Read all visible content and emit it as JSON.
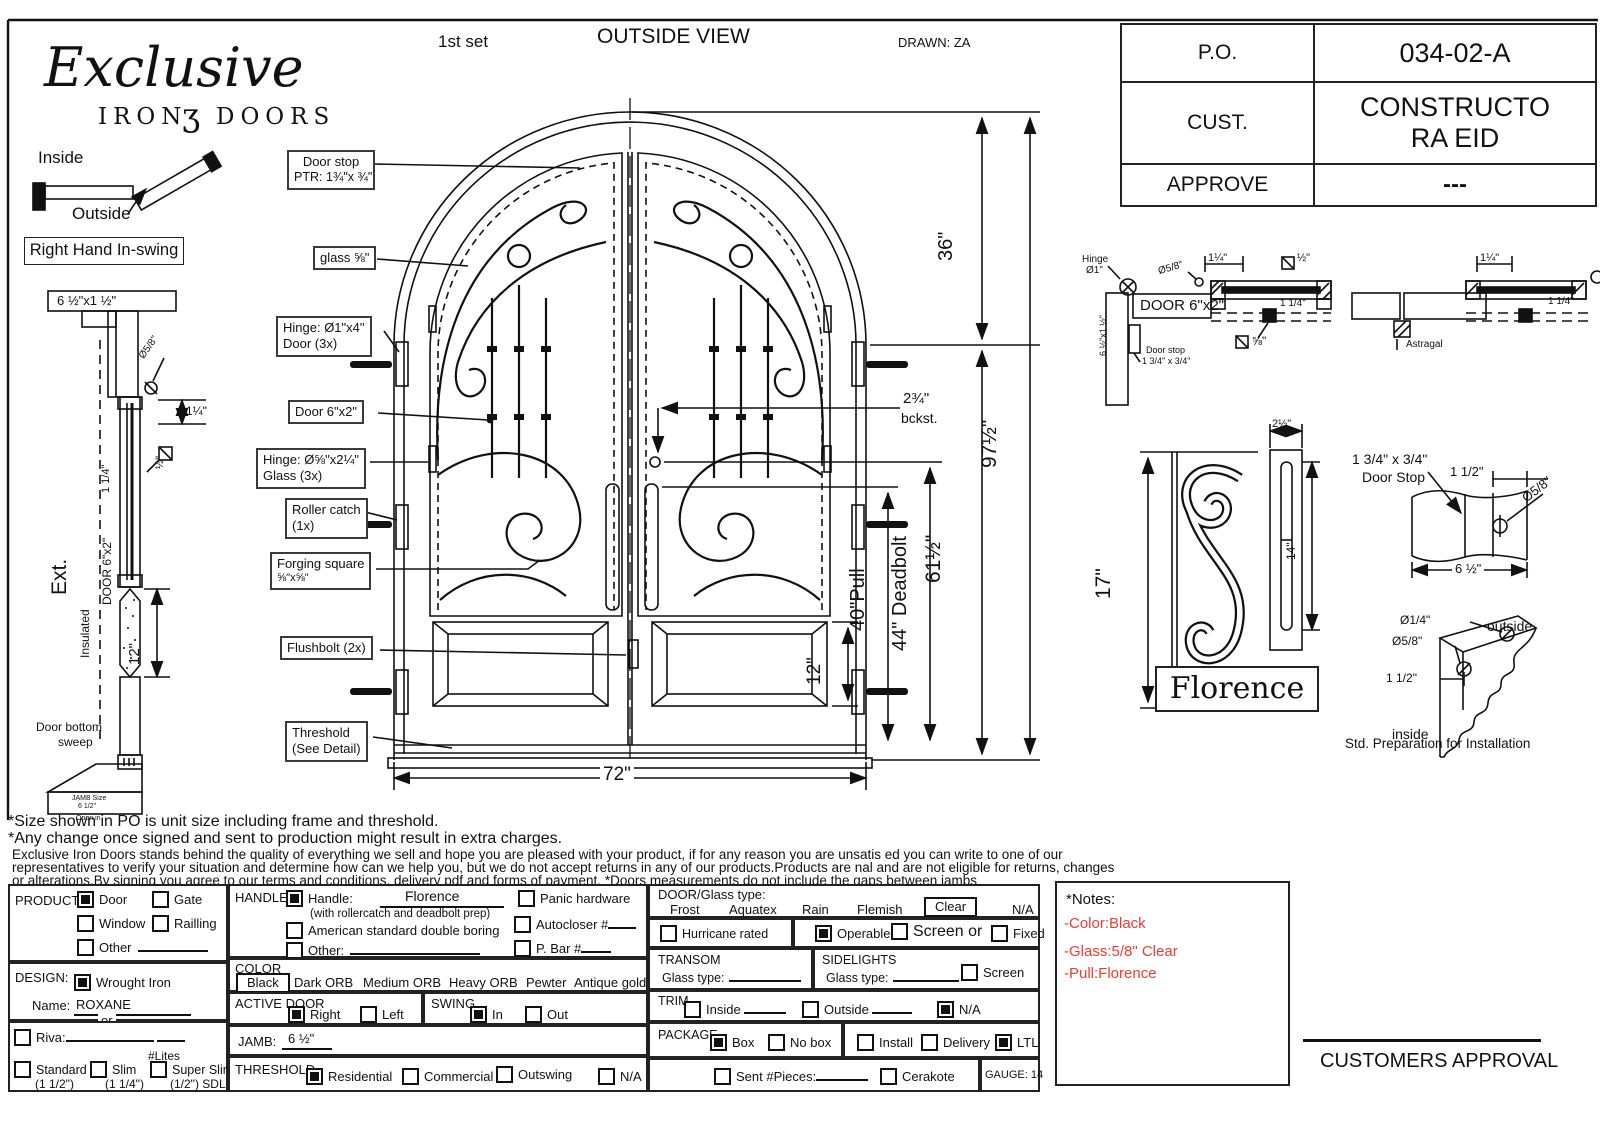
{
  "colors": {
    "ink": "#111111",
    "red": "#f03b30",
    "paper": "#ffffff"
  },
  "header": {
    "set": "1st set",
    "view": "OUTSIDE VIEW",
    "drawn": "DRAWN: ZA"
  },
  "brand": {
    "name": "Exclusive",
    "sub_left": "IRON",
    "scroll": "ʒ",
    "sub_right": "DOORS"
  },
  "orientation": {
    "inside": "Inside",
    "outside": "Outside",
    "swing": "Right Hand In-swing"
  },
  "title_block": {
    "rows": [
      {
        "label": "P.O.",
        "value": "034-02-A"
      },
      {
        "label": "CUST.",
        "value": "CONSTRUCTORA EID"
      },
      {
        "label": "APPROVE",
        "value": "---"
      }
    ]
  },
  "callouts": {
    "door_stop_1": "Door stop",
    "door_stop_2": "PTR: 1¾\"x ¾\"",
    "glass": "glass ⅝\"",
    "hinge_door_1": "Hinge: Ø1\"x4\"",
    "hinge_door_2": "Door (3x)",
    "door": "Door  6\"x2\"",
    "hinge_glass_1": "Hinge: Ø⅝\"x2¼\"",
    "hinge_glass_2": "Glass (3x)",
    "roller_1": "Roller catch",
    "roller_2": "(1x)",
    "forging_1": "Forging square",
    "forging_2": "⅝\"x⅝\"",
    "flushbolt": "Flushbolt (2x)",
    "threshold_1": "Threshold",
    "threshold_2": "(See Detail)"
  },
  "dims": {
    "d36": "36\"",
    "d615": "61½\"",
    "d975": "97½\"",
    "bckst1": "2¾\"",
    "bckst2": "bckst.",
    "pull": "40\"Pull",
    "deadbolt": "44\" Deadbolt",
    "d12panel": "12\"",
    "d72": "72\""
  },
  "left_profile": {
    "head": "6 ½\"x1 ½\"",
    "phi58": "Ø5/8\"",
    "d114": "1¼\"",
    "d114v": "1 1/4\"",
    "sq12": "½\"",
    "door": "DOOR 6\"x2\"",
    "ext": "Ext.",
    "insulated": "Insulated",
    "d12": "12\"",
    "sweep_1": "Door bottom",
    "sweep_2": "sweep",
    "jamb_1": "JAMB Size",
    "jamb_2": "6 1/2\"",
    "jamb_3": "Open in"
  },
  "detail_a": {
    "hinge_1": "Hinge",
    "hinge_2": "Ø1\"",
    "phi58": "Ø5/8\"",
    "d114": "1¼\"",
    "sq12": "½\"",
    "door": "DOOR 6\"x2\"",
    "d114i": "1 1/4\"",
    "jamb": "6 ½\"x1 ½\"",
    "stop_1": "Door stop",
    "stop_2": "1 3/4\" x 3/4\"",
    "sq58": "⅝\""
  },
  "detail_b": {
    "d114": "1¼\"",
    "d114i": "1 1/4\"",
    "astragal": "Astragal"
  },
  "florence": {
    "h17": "17\"",
    "w25": "2½\"",
    "h14": "14\"",
    "name": "Florence"
  },
  "stop_detail": {
    "t1": "1 3/4\" x 3/4\"",
    "t2": "Door Stop",
    "d112": "1 1/2\"",
    "phi58": "Ø5/8\"",
    "w": "6 ½\""
  },
  "corner_detail": {
    "phi14": "Ø1/4\"",
    "outside": "outside",
    "phi58": "Ø5/8\"",
    "d112": "1 1/2\"",
    "inside": "inside",
    "caption": "Std. Preparation for Installation"
  },
  "notes": {
    "l1": "*Size shown in PO is unit size including frame and threshold.",
    "l2": "*Any change once signed and sent to production might result in extra charges.",
    "l3": "Exclusive Iron Doors stands behind the quality of everything we sell and hope you are pleased with your product, if for any reason you are unsatis   ed you can write to one of our",
    "l4": "representatives to verify your situation and determine how can we help you, but we do not accept returns in any of our products.Products are    nal and are not eligible for returns, changes",
    "l5": "or alterations.By signing you agree to our terms and conditions, delivery pdf and forms of payment. *Doors measurements do not include the gaps between jambs"
  },
  "form": {
    "product": {
      "label": "PRODUCT:",
      "door": "Door",
      "gate": "Gate",
      "window": "Window",
      "railling": "Railling",
      "other": "Other"
    },
    "design": {
      "label": "DESIGN:",
      "wrought": "Wrought Iron",
      "name_label": "Name:",
      "name_value": "ROXANE",
      "or": "or",
      "riva": "Riva:",
      "lites": "#Lites",
      "standard": "Standard",
      "standard_s": "(1 1/2\")",
      "slim": "Slim",
      "slim_s": "(1 1/4\")",
      "super": "Super Slim",
      "super_s": "(1/2\") SDL"
    },
    "handle": {
      "label": "HANDLE",
      "handle": "Handle:",
      "value": "Florence",
      "sub": "(with rollercatch and deadbolt prep)",
      "american": "American standard double boring",
      "other": "Other:",
      "panic": "Panic hardware",
      "autocloser": "Autocloser #",
      "pbar": "P. Bar #"
    },
    "color": {
      "label": "COLOR",
      "black": "Black",
      "dark": "Dark ORB",
      "medium": "Medium ORB",
      "heavy": "Heavy ORB",
      "pewter": "Pewter",
      "antique": "Antique gold"
    },
    "active": {
      "label": "ACTIVE DOOR",
      "right": "Right",
      "left": "Left"
    },
    "swing": {
      "label": "SWING",
      "in": "In",
      "out": "Out"
    },
    "jamb": {
      "label": "JAMB:",
      "value": "6 ½\""
    },
    "threshold": {
      "label": "THRESHOLD",
      "residential": "Residential",
      "commercial": "Commercial",
      "outswing": "Outswing",
      "na": "N/A"
    },
    "glass": {
      "label": "DOOR/Glass type:",
      "frost": "Frost",
      "aquatex": "Aquatex",
      "rain": "Rain",
      "flemish": "Flemish",
      "clear": "Clear",
      "na": "N/A"
    },
    "options": {
      "hurricane": "Hurricane rated",
      "operable": "Operable",
      "screen_or": "Screen or",
      "fixed": "Fixed"
    },
    "transom": {
      "label": "TRANSOM",
      "glass": "Glass type:"
    },
    "sidelights": {
      "label": "SIDELIGHTS",
      "glass": "Glass type:",
      "screen": "Screen"
    },
    "trim": {
      "label": "TRIM",
      "inside": "Inside",
      "outside": "Outside",
      "na": "N/A"
    },
    "package": {
      "label": "PACKAGE",
      "box": "Box",
      "nobox": "No box",
      "install": "Install",
      "delivery": "Delivery",
      "ltl": "LTL"
    },
    "bottom": {
      "sent": "Sent #Pieces:",
      "cerakote": "Cerakote",
      "gauge": "GAUGE: 14"
    },
    "notes_title": "*Notes:",
    "notes": [
      "-Color:Black",
      "-Glass:5/8\" Clear",
      "-Pull:Florence"
    ],
    "state": {
      "door": true,
      "gate": false,
      "window": false,
      "railling": false,
      "other": false,
      "wrought": true,
      "riva": false,
      "standard": false,
      "slim": false,
      "super": false,
      "handle": true,
      "american": false,
      "other_handle": false,
      "panic": false,
      "autocloser": false,
      "pbar": false,
      "right": true,
      "left": false,
      "in": true,
      "out": false,
      "residential": true,
      "commercial": false,
      "outswing": false,
      "thresh_na": false,
      "hurricane": false,
      "operable": true,
      "screen": false,
      "fixed": false,
      "sidelight_screen": false,
      "trim_inside": false,
      "trim_outside": false,
      "trim_na": true,
      "box": true,
      "nobox": false,
      "install": false,
      "delivery": false,
      "ltl": true,
      "sent": false,
      "cerakote": false
    }
  },
  "approval": "CUSTOMERS APPROVAL"
}
